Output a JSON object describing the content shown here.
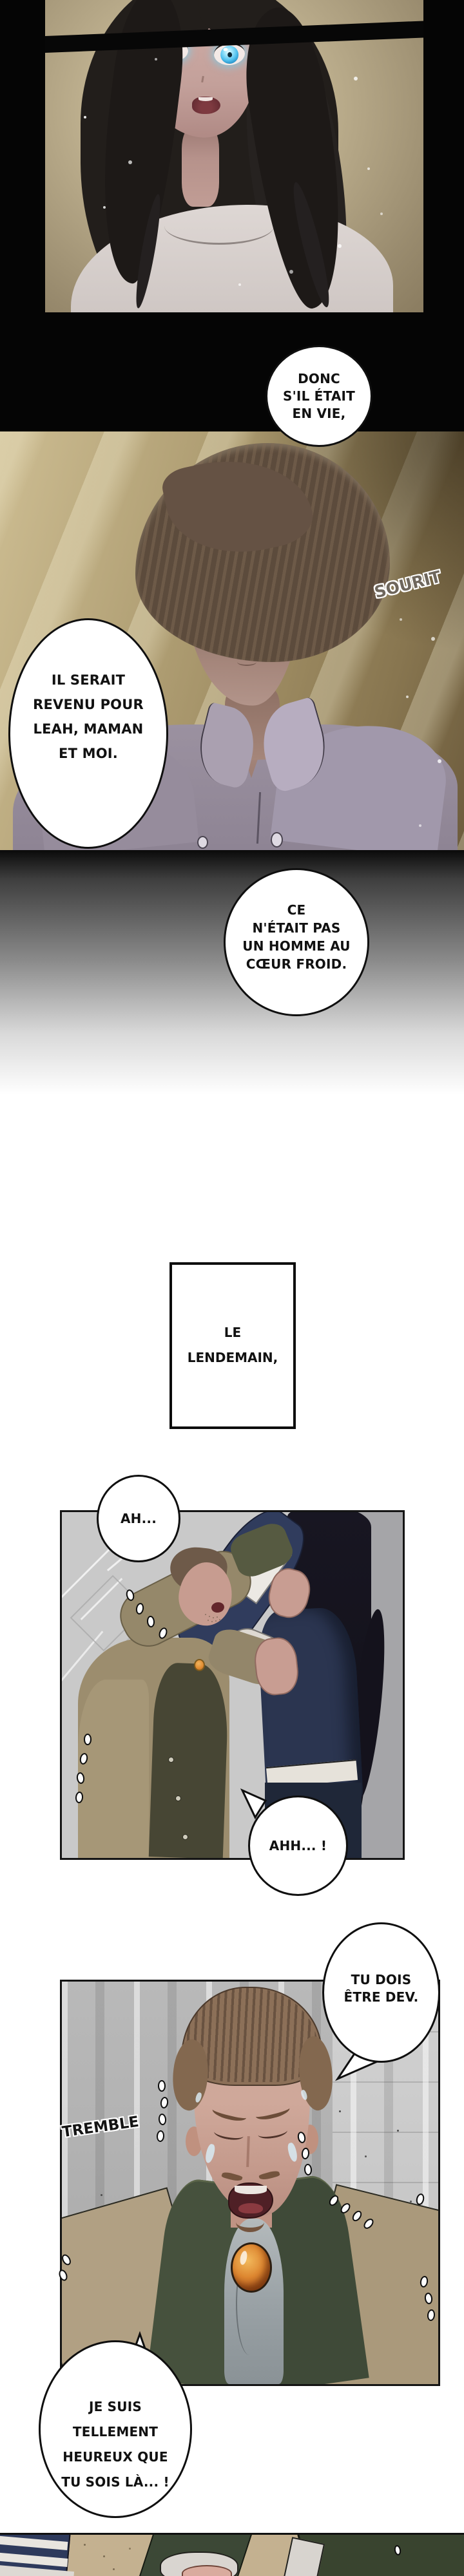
{
  "bubbles": {
    "donc": {
      "lines": [
        "DONC",
        "S'IL ÉTAIT",
        "EN VIE,"
      ]
    },
    "il_serait": {
      "lines": [
        "IL SERAIT",
        "REVENU POUR",
        "LEAH, MAMAN",
        "ET MOI."
      ]
    },
    "coeur_froid": {
      "lines": [
        "CE",
        "N'ÉTAIT PAS",
        "UN HOMME AU",
        "CŒUR FROID."
      ]
    },
    "ah": {
      "lines": [
        "AH..."
      ]
    },
    "ahh": {
      "lines": [
        "AHH... !"
      ]
    },
    "tu_dois": {
      "lines": [
        "TU DOIS",
        "ÊTRE DEV."
      ]
    },
    "je_suis": {
      "lines": [
        "JE SUIS",
        "TELLEMENT",
        "HEUREUX QUE",
        "TU SOIS LÀ... !"
      ]
    }
  },
  "caption": {
    "lines": [
      "LE",
      "LENDEMAIN,"
    ]
  },
  "sfx": {
    "sourit": "SOURIT",
    "tremble": "TREMBLE"
  },
  "colors": {
    "page_black": "#050505",
    "eye_glow": "#6fd4f5",
    "panel2_gold": "#a5976f",
    "panel3_gray": "#c9c9c9",
    "navy_jacket": "#2b3550",
    "olive_coat": "#9d8e6e",
    "green_coat": "#45503c",
    "brooch_orange": "#dd8630",
    "tan_coat": "#b1a083"
  }
}
